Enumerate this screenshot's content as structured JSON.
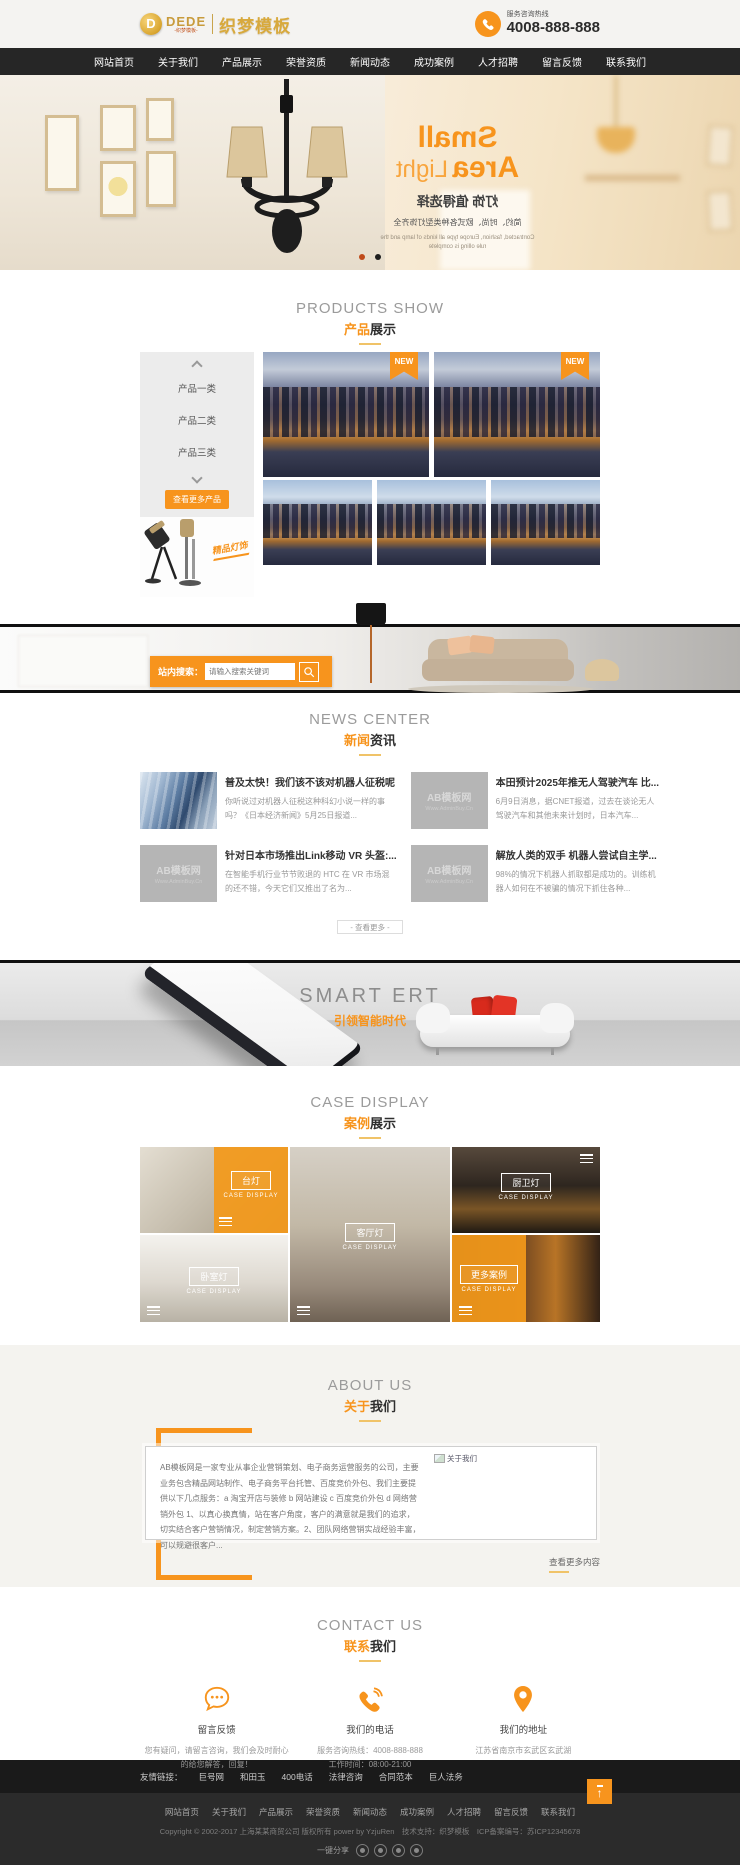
{
  "colors": {
    "accent": "#f7941d",
    "nav_bg": "#262626",
    "dot_active": "#bf4a1a",
    "dot_idle": "#1d1d1d"
  },
  "header": {
    "coin_letter": "D",
    "brand": "DEDE",
    "brand_sub": "-织梦模板-",
    "site_name": "织梦模板",
    "hotline_label": "服务咨询热线",
    "hotline_number": "4008-888-888"
  },
  "nav": {
    "items": [
      "网站首页",
      "关于我们",
      "产品展示",
      "荣誉资质",
      "新闻动态",
      "成功案例",
      "人才招聘",
      "留言反馈",
      "联系我们"
    ]
  },
  "hero": {
    "title_word1": "Small",
    "title_word2": "Area",
    "title_word3": "Light",
    "subtitle": "灯饰 值得选择",
    "desc": "简约、时尚、欧式各种类型灯饰齐全",
    "desc_en1": "Contracted, fashion, Europe type all kinds of lamp and the",
    "desc_en2": "rule olling is complete"
  },
  "products": {
    "title_en": "PRODUCTS SHOW",
    "title_zh_accent": "产品",
    "title_zh": "展示",
    "categories": [
      "产品一类",
      "产品二类",
      "产品三类"
    ],
    "more_button": "查看更多产品",
    "badge": "精品灯饰",
    "new_badge": "NEW"
  },
  "search": {
    "label": "站内搜索：",
    "placeholder": "请输入搜索关键词"
  },
  "news": {
    "title_en": "NEWS CENTER",
    "title_zh_accent": "新闻",
    "title_zh": "资讯",
    "placeholder_line1": "AB模板网",
    "placeholder_line2": "Www.AdminBuy.Cn",
    "more_button": "- 查看更多 -",
    "items": [
      {
        "title": "普及太快！我们该不该对机器人征税呢",
        "body": "你听说过对机器人征税这种科幻小说一样的事吗？《日本经济新闻》5月25日报道..."
      },
      {
        "title": "本田预计2025年推无人驾驶汽车 比...",
        "body": "6月9日消息，据CNET报道，过去在谈论无人驾驶汽车和其他未来计划时，日本汽车..."
      },
      {
        "title": "针对日本市场推出Link移动 VR 头盔:...",
        "body": "在智能手机行业节节败退的 HTC 在 VR 市场混的还不错，今天它们又推出了名为..."
      },
      {
        "title": "解放人类的双手 机器人尝试自主学...",
        "body": "98%的情况下机器人抓取都是成功的。训练机器人如何在不被骗的情况下抓住各种..."
      }
    ]
  },
  "smart": {
    "title": "SMART ERT",
    "subtitle": "引领智能时代"
  },
  "cases": {
    "title_en": "CASE DISPLAY",
    "title_zh_accent": "案例",
    "title_zh": "展示",
    "sub": "CASE DISPLAY",
    "tiles": [
      {
        "label": "台灯"
      },
      {
        "label": "卧室灯"
      },
      {
        "label": "客厅灯"
      },
      {
        "label": "厨卫灯"
      },
      {
        "label": "更多案例"
      }
    ]
  },
  "about": {
    "title_en": "ABOUT US",
    "title_zh_accent": "关于",
    "title_zh": "我们",
    "broken_image_label": "关于我们",
    "paragraph": "AB模板网是一家专业从事企业营销策划、电子商务运营服务的公司，主要业务包含精品网站制作、电子商务平台托管、百度竞价外包、我们主要提供以下几点服务：a 淘宝开店与装修 b 网站建设 c 百度竞价外包 d 网络营销外包 1、以真心换真情，站在客户角度，客户的满意就是我们的追求，切实结合客户营销情况，制定营销方案。2、团队网络营销实战经验丰富，可以规避很客户...",
    "more_link": "查看更多内容"
  },
  "contact": {
    "title_en": "CONTACT US",
    "title_zh_accent": "联系",
    "title_zh": "我们",
    "cards": [
      {
        "title": "留言反馈",
        "line1": "您有疑问，请留言咨询，我们会及时耐心",
        "line2": "的给您解答，回复！"
      },
      {
        "title": "我们的电话",
        "line1": "服务咨询热线：4008-888-888",
        "line2": "工作时间：08:00-21:00"
      },
      {
        "title": "我们的地址",
        "line1": "江苏省南京市玄武区玄武湖",
        "line2": ""
      }
    ]
  },
  "footer": {
    "links_label": "友情链接：",
    "links": [
      "巨号网",
      "和田玉",
      "400电话",
      "法律咨询",
      "合同范本",
      "巨人法务"
    ],
    "nav": [
      "网站首页",
      "关于我们",
      "产品展示",
      "荣誉资质",
      "新闻动态",
      "成功案例",
      "人才招聘",
      "留言反馈",
      "联系我们"
    ],
    "copyright": "Copyright © 2002-2017 上海某某商贸公司 版权所有 power by YzjuRen　技术支持：织梦模板　ICP备案编号：苏ICP12345678",
    "share_label": "一键分享"
  }
}
